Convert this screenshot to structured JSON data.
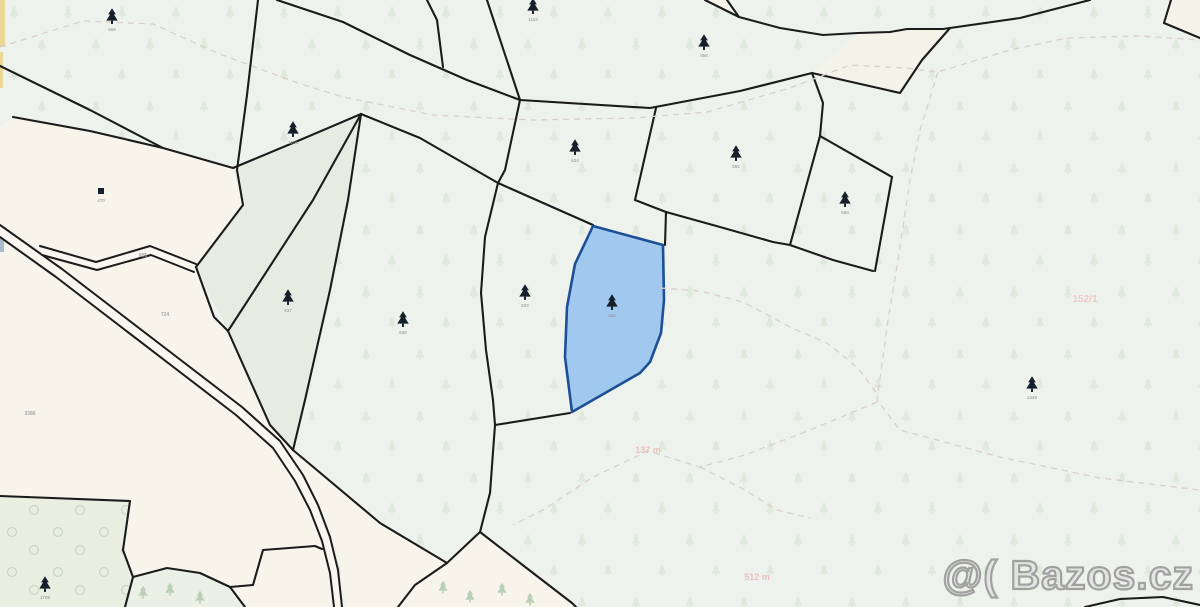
{
  "watermark": {
    "text": "@( Bazos.cz"
  },
  "colors": {
    "background": "#eef2ec",
    "cream": "#f7f5eb",
    "wedge": "#e5ebe2",
    "road_fill": "#f8f6ee",
    "line": "#1b1b1b",
    "dash": "#d9cfc9",
    "highlight_fill": "#9cc6f0",
    "highlight_stroke": "#1d4f96",
    "pattern_tree": "#dde9da",
    "pattern_circle": "#c6d9bf",
    "tree_icon": "#15202b",
    "shrub_tree": "#b9cfb6",
    "yellow_strip": "#e9d795",
    "blue_sliver": "#a9bccd"
  },
  "map": {
    "parcels": [
      {
        "name": "parcel-cream-topleft",
        "points": "0,128 13,117 163,148 233,168 243,205 196,267 150,251 98,267 40,248 0,228",
        "fill": "#f7f5eb",
        "opacity": 1
      },
      {
        "name": "parcel-wedge-upper",
        "points": "233,168 300,140 361,114 313,200 228,331 196,267 243,205",
        "fill": "#e5ebe2",
        "opacity": 0.85
      },
      {
        "name": "parcel-wedge-lower",
        "points": "228,331 253,387 270,425 293,450 305,400 330,290 348,200 361,114 313,200",
        "fill": "#e5ebe2",
        "opacity": 0.85
      },
      {
        "name": "parcel-cream-west",
        "points": "0,240 60,282 120,327 180,372 240,418 276,452 302,494 324,530 334,560 340,607 0,607",
        "fill": "#f7f5eb",
        "opacity": 1
      },
      {
        "name": "parcel-cream-central",
        "points": "196,268 214,317 228,331 253,387 270,425 293,450 380,523 447,563 415,585 398,607 346,607 338,555 325,515 300,483 270,438 225,395 170,352 100,302 42,254 44,256 97,271 151,256 193,272",
        "fill": "#f7f5eb",
        "opacity": 1
      },
      {
        "name": "parcel-cream-corridor-se",
        "points": "447,563 480,532 533,573 575,607 398,607 415,585",
        "fill": "#f7f5eb",
        "opacity": 1
      },
      {
        "name": "parcel-green-strip-bottom",
        "points": "133,577 167,568 200,573 230,587 245,607 125,607",
        "fill": "#ebf0e6",
        "opacity": 1
      },
      {
        "name": "parcel-band-topright",
        "points": "812,73 900,93 922,60 950,28 907,29 858,33",
        "fill": "#f4f3ea",
        "opacity": 1
      },
      {
        "name": "parcel-corner-topright",
        "points": "1171,0 1164,23 1200,38 1200,0",
        "fill": "#f4f3ea",
        "opacity": 1
      },
      {
        "name": "parcel-sliver-topcenter",
        "points": "705,0 727,0 739,17",
        "fill": "#f4f3ea",
        "opacity": 1
      },
      {
        "name": "yellow-road-strip-a",
        "points": "0,0 5,0 5,47 0,47",
        "fill": "#e9d795",
        "opacity": 1
      },
      {
        "name": "yellow-road-strip-b",
        "points": "0,52 3,52 3,88 0,88",
        "fill": "#e9d795",
        "opacity": 1
      },
      {
        "name": "blue-edge-sliver",
        "points": "0,236 4,236 4,252 0,252",
        "fill": "#a9bccd",
        "opacity": 1
      },
      {
        "name": "parcel-green-deciduous",
        "points": "0,496 130,501 123,550 133,577 125,607 0,607",
        "fill": "#e9eee1",
        "opacity": 1,
        "pattern": "pat-circles"
      }
    ],
    "roads": [
      {
        "name": "main-road",
        "edge1": "0,225 62,269 122,315 182,361 242,407 280,441 303,475 318,505 330,537 338,570 342,607",
        "edge2": "0,237 56,277 116,323 176,369 236,415 273,448 295,481 310,510 322,541 330,573 334,607"
      },
      {
        "name": "branch-road",
        "edge1": "40,246 96,262 150,246 196,264",
        "edge2": "42,255 97,270 151,255 194,272"
      }
    ],
    "lines": [
      {
        "name": "boundary-a",
        "points": "0,66 90,110 163,148 233,168 300,140 361,114"
      },
      {
        "name": "boundary-p1-top",
        "points": "13,117 90,131 163,148"
      },
      {
        "name": "boundary-b",
        "points": "258,0 247,95 237,170 243,205 196,267"
      },
      {
        "name": "boundary-l1",
        "points": "277,0 343,22 410,55 467,80 520,100"
      },
      {
        "name": "boundary-e",
        "points": "361,114 420,138 498,183 593,225"
      },
      {
        "name": "boundary-f",
        "points": "361,114 348,200 330,290 305,400 293,450"
      },
      {
        "name": "boundary-e-west",
        "points": "361,114 313,200 228,331"
      },
      {
        "name": "boundary-d",
        "points": "196,267 214,317 228,331 253,387 270,425 293,450"
      },
      {
        "name": "boundary-g",
        "points": "293,450 380,523 447,563"
      },
      {
        "name": "boundary-v",
        "points": "520,100 505,170 498,183 485,237 481,293 486,350 493,400 495,425 490,493 480,532"
      },
      {
        "name": "boundary-h",
        "points": "480,532 447,563"
      },
      {
        "name": "boundary-i",
        "points": "480,532 533,573 572,603 576,607"
      },
      {
        "name": "boundary-corridor-east",
        "points": "447,563 415,585 398,607"
      },
      {
        "name": "boundary-blue-south",
        "points": "495,425 570,413"
      },
      {
        "name": "boundary-topcenter-1",
        "points": "427,0 437,20 443,67"
      },
      {
        "name": "boundary-topcenter-2",
        "points": "487,0 520,100"
      },
      {
        "name": "boundary-t1",
        "points": "520,100 650,108 740,91 812,73 900,93 922,60 950,28"
      },
      {
        "name": "boundary-ne-down",
        "points": "656,108 635,200 666,212"
      },
      {
        "name": "boundary-blue-east-top",
        "points": "666,212 665,245"
      },
      {
        "name": "boundary-east-chain",
        "points": "666,212 720,227 773,242 790,245 833,260 873,271"
      },
      {
        "name": "boundary-diamond-nw",
        "points": "812,73 823,103 820,136"
      },
      {
        "name": "boundary-diamond-w",
        "points": "820,136 790,245"
      },
      {
        "name": "boundary-diamond-ne",
        "points": "820,136 892,177"
      },
      {
        "name": "boundary-diamond-se",
        "points": "892,177 875,271"
      },
      {
        "name": "boundary-t2",
        "points": "705,0 739,17 780,28 823,35 858,33 890,32 907,29 943,29 1020,18 1090,0"
      },
      {
        "name": "boundary-sliver",
        "points": "727,0 739,17"
      },
      {
        "name": "boundary-corner-ne",
        "points": "1171,0 1164,23 1200,38"
      },
      {
        "name": "boundary-bottom-right",
        "points": "1085,607 1120,599 1163,597 1200,605"
      },
      {
        "name": "boundary-green-a",
        "points": "0,496 130,501 123,550 133,577 125,607"
      },
      {
        "name": "boundary-green-b",
        "points": "133,577 167,568 200,573 230,587 245,607"
      },
      {
        "name": "boundary-green-c",
        "points": "230,587 253,585 263,550 315,546 322,549"
      }
    ],
    "highlight": {
      "name": "highlighted-parcel",
      "points": "593,226 663,245 664,300 661,333 650,362 640,373 572,412 565,357 567,307 575,264"
    },
    "dashes": [
      {
        "name": "footpath-north",
        "points": "0,47 83,21 153,24 217,53 298,83 343,97 433,115 533,120 633,118 707,112 790,88 850,65 905,68 938,72 1010,50 1067,38 1140,36 1200,40"
      },
      {
        "name": "footpath-east",
        "points": "938,72 920,130 910,180 898,260 888,320 877,400 900,430 1000,457 1100,478 1200,490"
      },
      {
        "name": "footpath-mid",
        "points": "660,288 700,291 743,302 790,327 827,343 858,368 878,395"
      },
      {
        "name": "footpath-southwest",
        "points": "877,402 810,430 745,455 700,467 648,451 593,477 543,510 513,525"
      },
      {
        "name": "footpath-south-spur",
        "points": "700,467 745,490 777,510 810,518"
      }
    ],
    "trees": [
      {
        "x": 112,
        "y": 16,
        "label": "659"
      },
      {
        "x": 293,
        "y": 129,
        "label": "1106"
      },
      {
        "x": 533,
        "y": 6,
        "label": "1104"
      },
      {
        "x": 575,
        "y": 147,
        "label": "634"
      },
      {
        "x": 704,
        "y": 42,
        "label": "656"
      },
      {
        "x": 736,
        "y": 153,
        "label": "655"
      },
      {
        "x": 845,
        "y": 199,
        "label": "658"
      },
      {
        "x": 288,
        "y": 297,
        "label": "637"
      },
      {
        "x": 403,
        "y": 319,
        "label": "636"
      },
      {
        "x": 525,
        "y": 292,
        "label": "633"
      },
      {
        "x": 612,
        "y": 302,
        "label": "632"
      },
      {
        "x": 1032,
        "y": 384,
        "label": "1348"
      },
      {
        "x": 45,
        "y": 584,
        "label": "1709"
      }
    ],
    "square_symbols": [
      {
        "x": 101,
        "y": 191,
        "label": "470"
      }
    ],
    "shrubs": [
      {
        "x": 143,
        "y": 592
      },
      {
        "x": 170,
        "y": 589
      },
      {
        "x": 200,
        "y": 597
      },
      {
        "x": 443,
        "y": 587
      },
      {
        "x": 470,
        "y": 596
      },
      {
        "x": 502,
        "y": 589
      },
      {
        "x": 530,
        "y": 599
      }
    ],
    "labels": [
      {
        "name": "parcel-number-724",
        "text": "724",
        "x": 165,
        "y": 316,
        "size": 5,
        "color": "#9aa0a0"
      },
      {
        "name": "parcel-number-3386",
        "text": "3386",
        "x": 30,
        "y": 415,
        "size": 5,
        "color": "#9aa0a0"
      },
      {
        "name": "road-number-805",
        "text": "805",
        "x": 143,
        "y": 257,
        "size": 5,
        "color": "#9aa0a0"
      },
      {
        "name": "distance-label-137m",
        "text": "137 m",
        "x": 648,
        "y": 453,
        "size": 9,
        "color": "#eab9b9"
      },
      {
        "name": "distance-label-512m",
        "text": "512 m",
        "x": 757,
        "y": 580,
        "size": 9,
        "color": "#eab9b9"
      },
      {
        "name": "parcel-number-pink",
        "text": "152/1",
        "x": 1085,
        "y": 302,
        "size": 10,
        "color": "#f0c4c4"
      }
    ]
  }
}
